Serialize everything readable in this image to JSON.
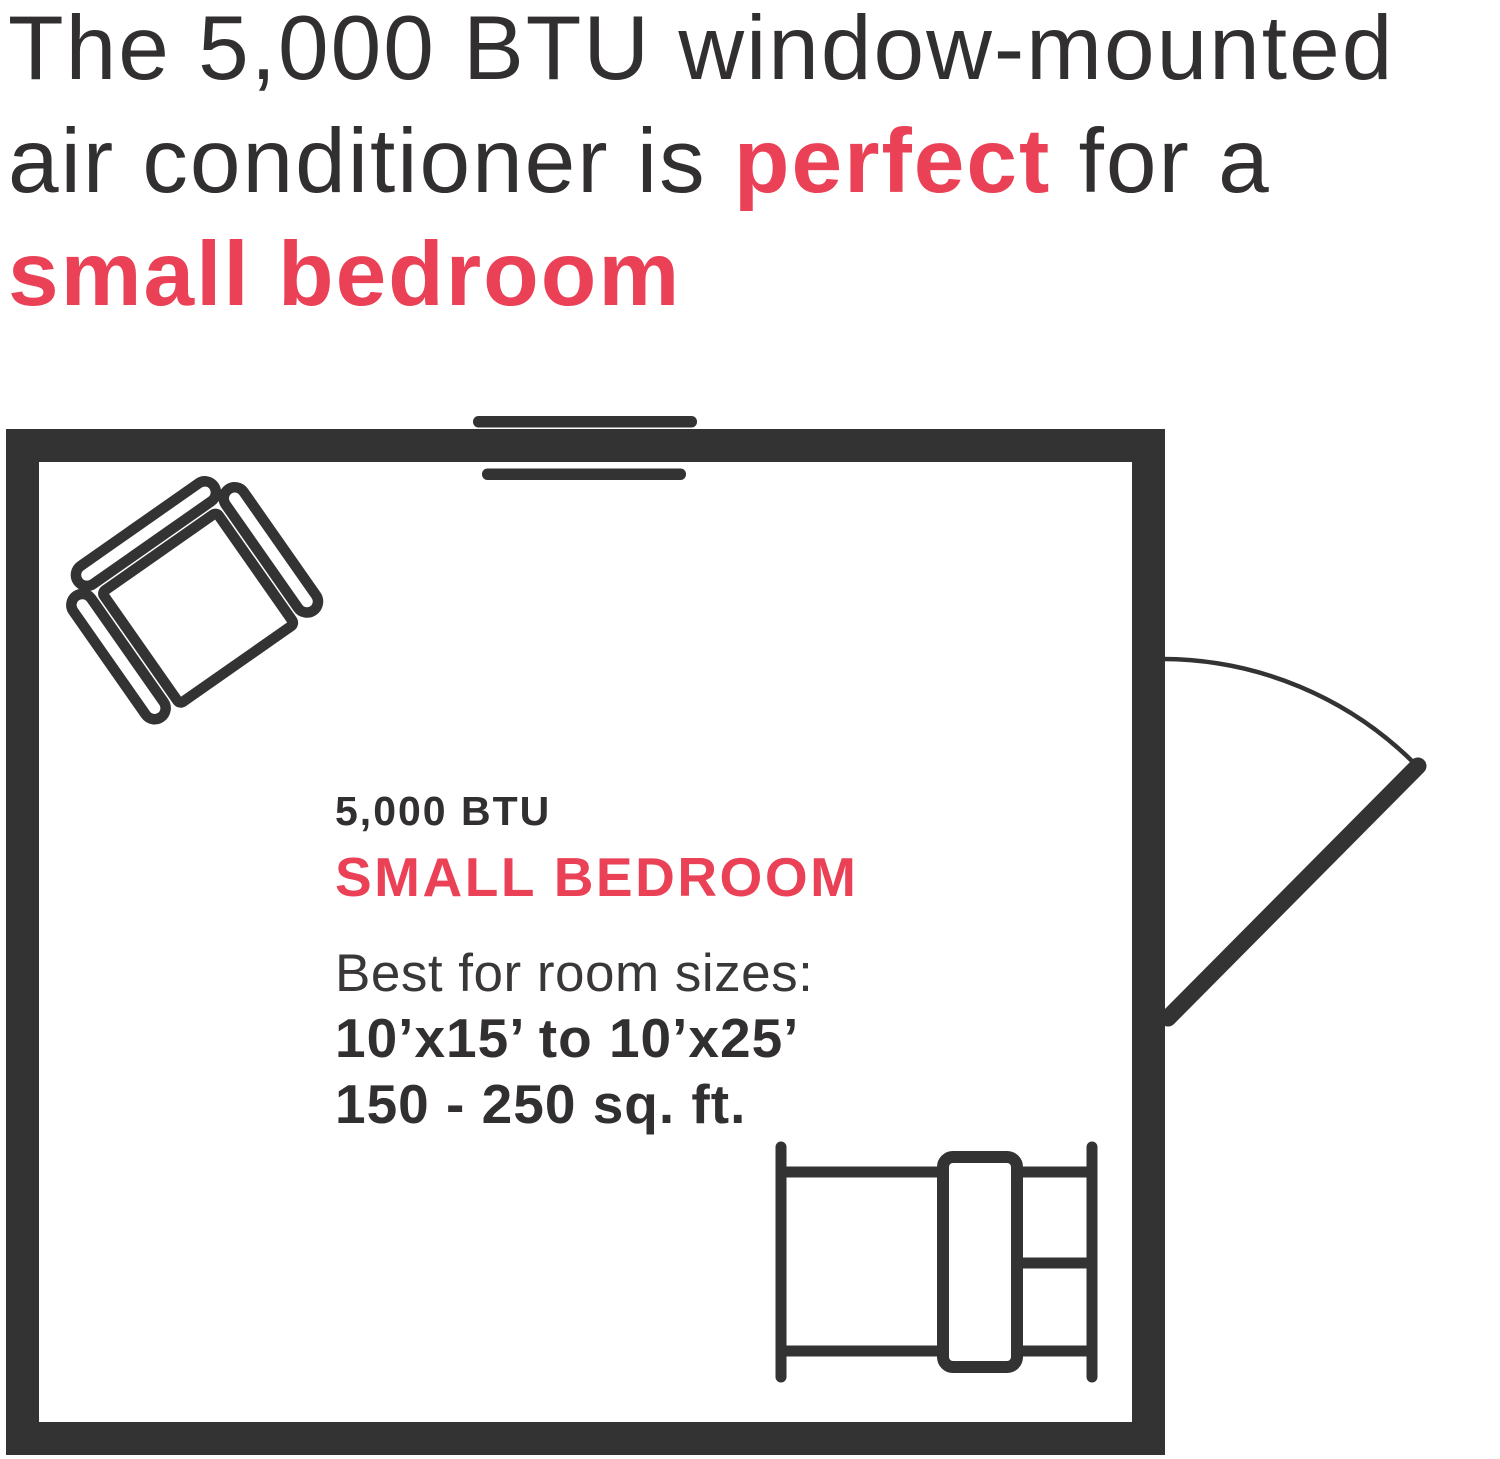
{
  "colors": {
    "accent": "#EA4156",
    "ink": "#322F30",
    "wall": "#333333"
  },
  "headline": {
    "line1": "The 5,000 BTU window-mounted",
    "line2_pre": "air conditioner is ",
    "line2_highlight": "perfect",
    "line2_post": " for a",
    "line3": "small bedroom"
  },
  "floor_plan": {
    "label": {
      "btu": "5,000 BTU",
      "room_type": "SMALL BEDROOM",
      "subtitle": "Best for room sizes:",
      "dimensions": "10’x15’ to 10’x25’",
      "area": "150 - 250 sq. ft."
    },
    "icons": {
      "window_ac": "window-ac-unit",
      "armchair": "armchair-top-view",
      "door": "door-swing",
      "bed": "bed-top-view"
    }
  }
}
